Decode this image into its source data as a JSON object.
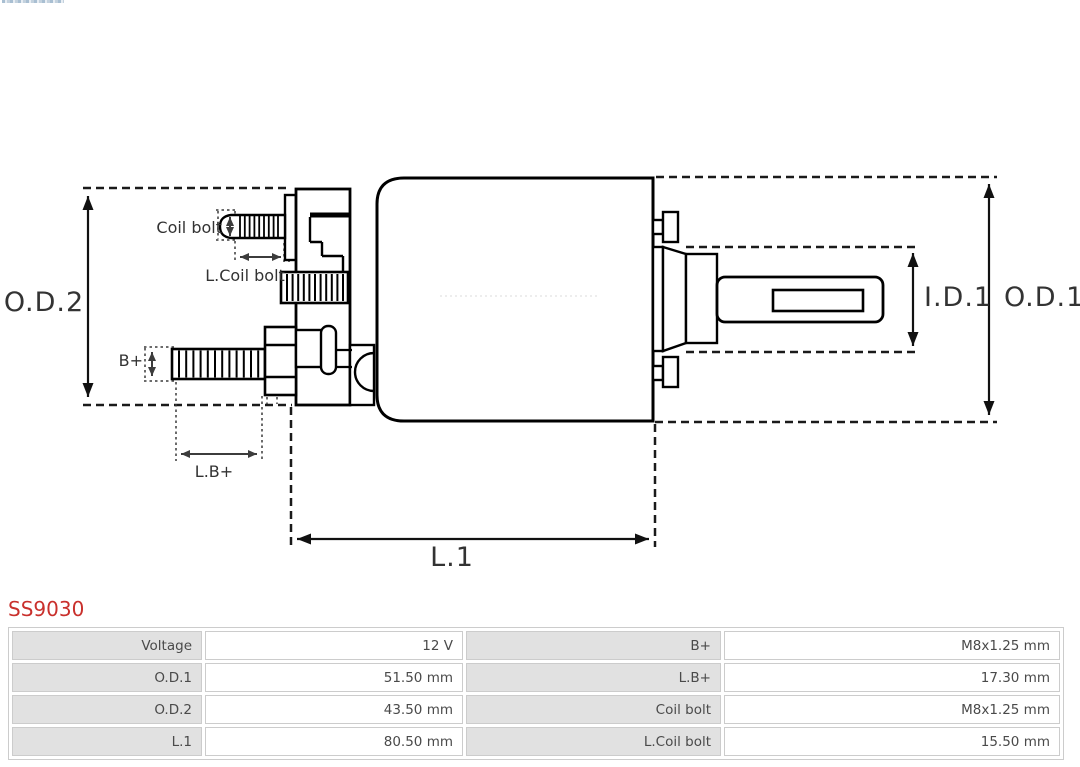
{
  "product": {
    "code": "SS9030",
    "code_color": "#c9302c"
  },
  "diagram": {
    "labels": {
      "od2": "O.D.2",
      "od1": "O.D.1",
      "id1": "I.D.1",
      "l1": "L.1",
      "coil_bolt": "Coil bolt",
      "l_coil_bolt": "L.Coil bolt",
      "b_plus": "B+",
      "l_b_plus": "L.B+"
    },
    "outline_color": "#000000",
    "dash_color": "#1a1a1a",
    "label_color": "#333333"
  },
  "spec_table": {
    "label_bg": "#e1e1e1",
    "border_color": "#cccccc",
    "text_color": "#4a4a4a",
    "rows": [
      {
        "label_left": "Voltage",
        "value_left": "12 V",
        "label_right": "B+",
        "value_right": "M8x1.25 mm"
      },
      {
        "label_left": "O.D.1",
        "value_left": "51.50 mm",
        "label_right": "L.B+",
        "value_right": "17.30 mm"
      },
      {
        "label_left": "O.D.2",
        "value_left": "43.50 mm",
        "label_right": "Coil bolt",
        "value_right": "M8x1.25 mm"
      },
      {
        "label_left": "L.1",
        "value_left": "80.50 mm",
        "label_right": "L.Coil bolt",
        "value_right": "15.50 mm"
      }
    ]
  }
}
